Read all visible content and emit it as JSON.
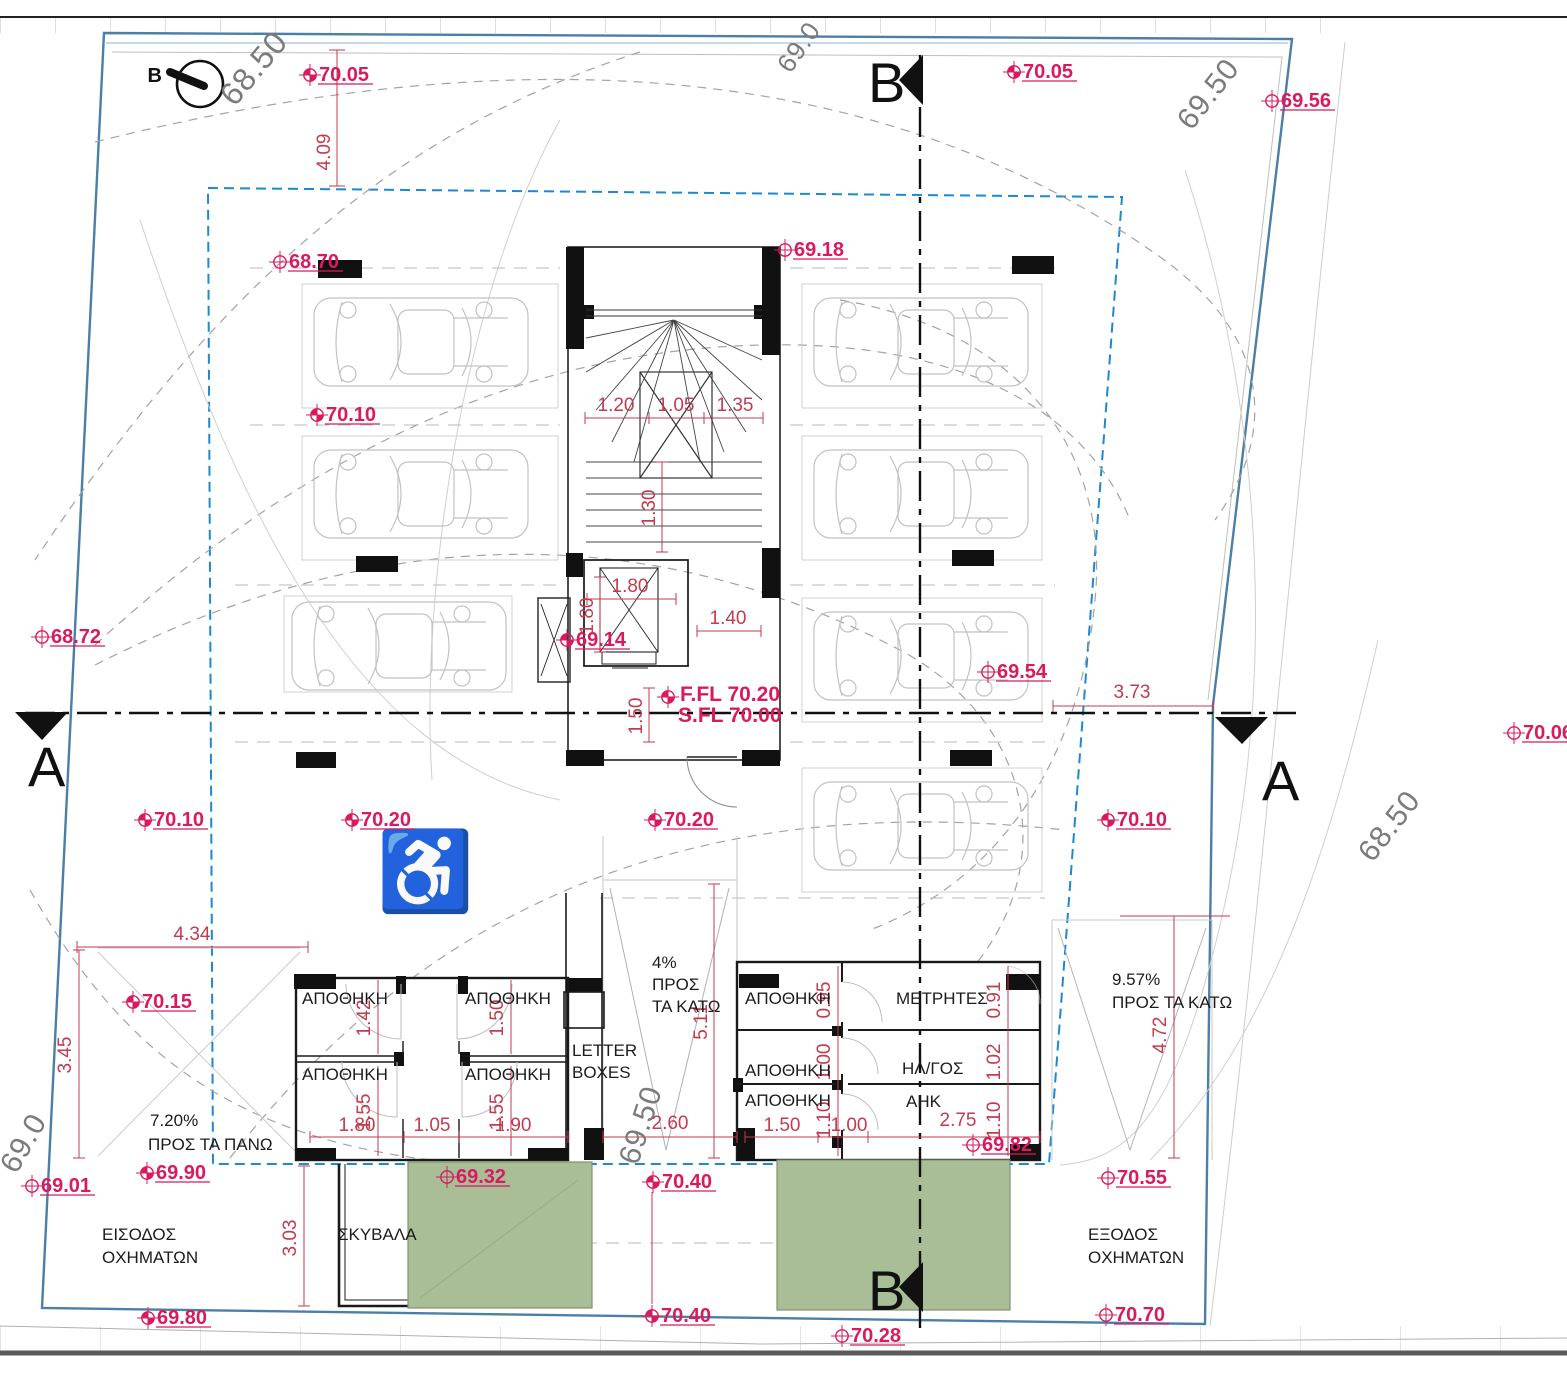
{
  "drawing": {
    "type": "architectural-site-plan"
  },
  "colors": {
    "spot_level": "#d81b5f",
    "dimension": "#c23b4f",
    "site_boundary": "#4b7fa6",
    "setback_boundary": "#1f88cf",
    "green_area": "#a9bd97",
    "contour_text": "#7b7b7b",
    "wall": "#1a1a1a"
  },
  "north": {
    "label": "B"
  },
  "floor_level": {
    "line1": "F.FL 70.20",
    "line2": "S.FL 70.00"
  },
  "accessible_icon": {
    "glyph": "♿"
  },
  "spot_levels": [
    {
      "value": "70.05",
      "x": 310,
      "y": 75,
      "filled": true
    },
    {
      "value": "70.05",
      "x": 1014,
      "y": 72,
      "filled": true
    },
    {
      "value": "69.56",
      "x": 1272,
      "y": 101,
      "filled": false
    },
    {
      "value": "68.70",
      "x": 280,
      "y": 262,
      "filled": false
    },
    {
      "value": "69.18",
      "x": 785,
      "y": 250,
      "filled": false
    },
    {
      "value": "70.10",
      "x": 317,
      "y": 415,
      "filled": true
    },
    {
      "value": "68.72",
      "x": 42,
      "y": 637,
      "filled": false
    },
    {
      "value": "69.14",
      "x": 567,
      "y": 640,
      "filled": true
    },
    {
      "value": "69.54",
      "x": 988,
      "y": 672,
      "filled": false
    },
    {
      "value": "70.06",
      "x": 1514,
      "y": 733,
      "filled": false
    },
    {
      "value": "70.10",
      "x": 145,
      "y": 820,
      "filled": true
    },
    {
      "value": "70.20",
      "x": 352,
      "y": 820,
      "filled": true
    },
    {
      "value": "70.20",
      "x": 655,
      "y": 820,
      "filled": true
    },
    {
      "value": "70.10",
      "x": 1108,
      "y": 820,
      "filled": true
    },
    {
      "value": "70.15",
      "x": 133,
      "y": 1002,
      "filled": true
    },
    {
      "value": "69.90",
      "x": 147,
      "y": 1173,
      "filled": true
    },
    {
      "value": "69.01",
      "x": 32,
      "y": 1186,
      "filled": false
    },
    {
      "value": "69.32",
      "x": 447,
      "y": 1177,
      "filled": false
    },
    {
      "value": "70.40",
      "x": 653,
      "y": 1182,
      "filled": true
    },
    {
      "value": "69.82",
      "x": 973,
      "y": 1145,
      "filled": false
    },
    {
      "value": "70.55",
      "x": 1108,
      "y": 1178,
      "filled": false
    },
    {
      "value": "69.80",
      "x": 148,
      "y": 1318,
      "filled": true
    },
    {
      "value": "70.40",
      "x": 652,
      "y": 1316,
      "filled": true
    },
    {
      "value": "70.28",
      "x": 842,
      "y": 1336,
      "filled": false
    },
    {
      "value": "70.70",
      "x": 1106,
      "y": 1315,
      "filled": false
    }
  ],
  "dimensions": [
    {
      "value": "4.09",
      "x": 330,
      "y": 152,
      "vertical": true
    },
    {
      "value": "1.20",
      "x": 616,
      "y": 411,
      "vertical": false
    },
    {
      "value": "1.05",
      "x": 676,
      "y": 411,
      "vertical": false
    },
    {
      "value": "1.35",
      "x": 735,
      "y": 411,
      "vertical": false
    },
    {
      "value": "1.30",
      "x": 655,
      "y": 508,
      "vertical": true
    },
    {
      "value": "1.80",
      "x": 630,
      "y": 592,
      "vertical": false
    },
    {
      "value": "1.80",
      "x": 593,
      "y": 616,
      "vertical": true
    },
    {
      "value": "1.40",
      "x": 728,
      "y": 624,
      "vertical": false
    },
    {
      "value": "1.50",
      "x": 642,
      "y": 716,
      "vertical": true
    },
    {
      "value": "3.73",
      "x": 1132,
      "y": 698,
      "vertical": false
    },
    {
      "value": "4.34",
      "x": 192,
      "y": 940,
      "vertical": false
    },
    {
      "value": "3.45",
      "x": 71,
      "y": 1055,
      "vertical": true
    },
    {
      "value": "5.11",
      "x": 707,
      "y": 1022,
      "vertical": true
    },
    {
      "value": "1.42",
      "x": 370,
      "y": 1018,
      "vertical": true
    },
    {
      "value": "1.50",
      "x": 503,
      "y": 1018,
      "vertical": true
    },
    {
      "value": "1.55",
      "x": 370,
      "y": 1112,
      "vertical": true
    },
    {
      "value": "1.55",
      "x": 503,
      "y": 1112,
      "vertical": true
    },
    {
      "value": "1.80",
      "x": 357,
      "y": 1131,
      "vertical": false
    },
    {
      "value": "1.05",
      "x": 432,
      "y": 1131,
      "vertical": false
    },
    {
      "value": "1.90",
      "x": 513,
      "y": 1131,
      "vertical": false
    },
    {
      "value": "2.60",
      "x": 670,
      "y": 1129,
      "vertical": false
    },
    {
      "value": "1.50",
      "x": 782,
      "y": 1131,
      "vertical": false
    },
    {
      "value": "1.00",
      "x": 849,
      "y": 1131,
      "vertical": false
    },
    {
      "value": "2.75",
      "x": 958,
      "y": 1126,
      "vertical": false
    },
    {
      "value": "0.95",
      "x": 830,
      "y": 1000,
      "vertical": true
    },
    {
      "value": "1.00",
      "x": 830,
      "y": 1062,
      "vertical": true
    },
    {
      "value": "1.10",
      "x": 830,
      "y": 1120,
      "vertical": true
    },
    {
      "value": "0.91",
      "x": 1000,
      "y": 1000,
      "vertical": true
    },
    {
      "value": "1.02",
      "x": 1000,
      "y": 1062,
      "vertical": true
    },
    {
      "value": "1.10",
      "x": 1000,
      "y": 1120,
      "vertical": true
    },
    {
      "value": "4.72",
      "x": 1166,
      "y": 1035,
      "vertical": true
    },
    {
      "value": "3.03",
      "x": 296,
      "y": 1238,
      "vertical": true
    }
  ],
  "room_labels": [
    {
      "value": "ΑΠΟΘΗΚΗ",
      "x": 302,
      "y": 1004
    },
    {
      "value": "ΑΠΟΘΗΚΗ",
      "x": 465,
      "y": 1004
    },
    {
      "value": "ΑΠΟΘΗΚΗ",
      "x": 302,
      "y": 1080
    },
    {
      "value": "ΑΠΟΘΗΚΗ",
      "x": 465,
      "y": 1080
    },
    {
      "value": "ΑΠΟΘΗΚΗ",
      "x": 745,
      "y": 1004
    },
    {
      "value": "ΑΠΟΘΗΚΗ",
      "x": 745,
      "y": 1076
    },
    {
      "value": "ΑΠΟΘΗΚΗ",
      "x": 745,
      "y": 1106
    },
    {
      "value": "ΜΕΤΡΗΤΕΣ",
      "x": 896,
      "y": 1004
    },
    {
      "value": "ΗΛ/ΓΟΣ",
      "x": 902,
      "y": 1074
    },
    {
      "value": "ΑΗΚ",
      "x": 906,
      "y": 1107
    }
  ],
  "note_labels": [
    {
      "value": "4%",
      "x": 652,
      "y": 968
    },
    {
      "value": "ΠΡΟΣ",
      "x": 652,
      "y": 990
    },
    {
      "value": "ΤΑ ΚΑΤΩ",
      "x": 652,
      "y": 1012
    },
    {
      "value": "9.57%",
      "x": 1112,
      "y": 985
    },
    {
      "value": "ΠΡΟΣ ΤΑ ΚΑΤΩ",
      "x": 1112,
      "y": 1008
    },
    {
      "value": "7.20%",
      "x": 150,
      "y": 1126
    },
    {
      "value": "ΠΡΟΣ ΤΑ ΠΑΝΩ",
      "x": 148,
      "y": 1150
    },
    {
      "value": "ΕΙΣΟΔΟΣ",
      "x": 102,
      "y": 1240
    },
    {
      "value": "ΟΧΗΜΑΤΩΝ",
      "x": 102,
      "y": 1263
    },
    {
      "value": "ΕΞΟΔΟΣ",
      "x": 1088,
      "y": 1240
    },
    {
      "value": "ΟΧΗΜΑΤΩΝ",
      "x": 1088,
      "y": 1263
    },
    {
      "value": "ΣΚΥΒΑΛΑ",
      "x": 338,
      "y": 1240
    },
    {
      "value": "LETTER",
      "x": 572,
      "y": 1056
    },
    {
      "value": "BOXES",
      "x": 572,
      "y": 1078
    }
  ],
  "contour_labels": [
    {
      "value": "68.50",
      "x": 262,
      "y": 75,
      "rot": -50,
      "size": 32
    },
    {
      "value": "69.0",
      "x": 806,
      "y": 52,
      "rot": -55,
      "size": 26
    },
    {
      "value": "69.50",
      "x": 1216,
      "y": 100,
      "rot": -52,
      "size": 30
    },
    {
      "value": "68.50",
      "x": 1397,
      "y": 832,
      "rot": -52,
      "size": 30
    },
    {
      "value": "69.50",
      "x": 650,
      "y": 1128,
      "rot": -72,
      "size": 30
    },
    {
      "value": "69.0",
      "x": 32,
      "y": 1148,
      "rot": -60,
      "size": 30
    }
  ],
  "section_letters": [
    {
      "value": "A",
      "x": 28,
      "y": 786
    },
    {
      "value": "A",
      "x": 1262,
      "y": 800
    },
    {
      "value": "B",
      "x": 868,
      "y": 102
    },
    {
      "value": "B",
      "x": 868,
      "y": 1310
    }
  ]
}
